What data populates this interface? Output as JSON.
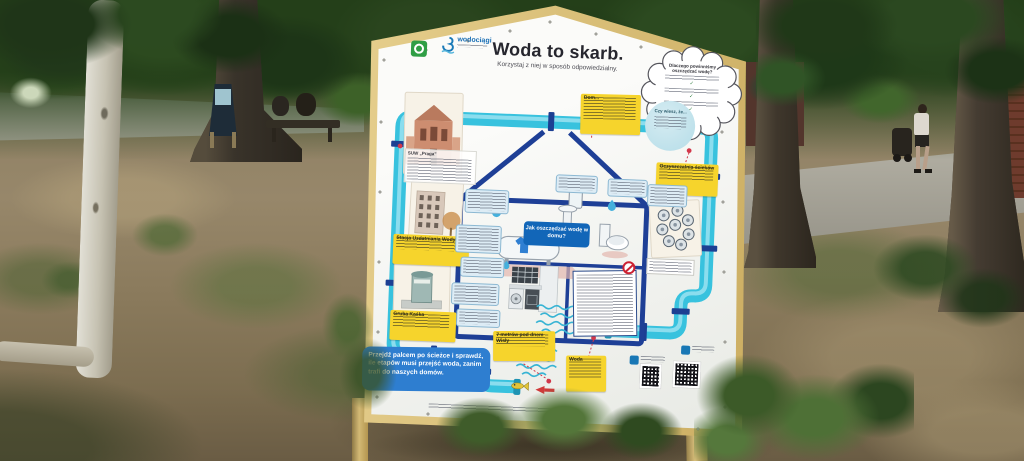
{
  "board": {
    "logo": {
      "waterworks_name": "wodociągi",
      "city_logo": "green-emblem"
    },
    "title": "Woda to skarb.",
    "subtitle": "Korzystaj z niej w sposób odpowiedzialny.",
    "cloud": {
      "title": "Dlaczego powinniśmy oszczędzać wodę?",
      "check": "✓"
    },
    "did_you_know": "Czy wiesz, że...",
    "boxes": {
      "dom": "Dom...",
      "oczyszczalnia": "Oczyszczalnia ścieków",
      "suw": "Stacja Uzdatniania Wody",
      "suw_note": "SUW „Praga”",
      "gruba_kaska": "Gruba Kaśka",
      "wisla": "7 metrów pod dnem Wisły",
      "woda": "Woda"
    },
    "badge": "Jak oszczędzać wodę w domu?",
    "banner": "Przejdź palcem po ścieżce i sprawdź, ile etapów musi przejść woda, zanim trafi do naszych domów.",
    "colors": {
      "pipe": "#38c2de",
      "navy": "#1e3f96",
      "label_yellow": "#f6d42c",
      "banner_blue": "#2e7ed0",
      "badge_blue": "#1266b8",
      "frame_tan": "#d8be7a",
      "marker_red": "#d2374a"
    }
  }
}
